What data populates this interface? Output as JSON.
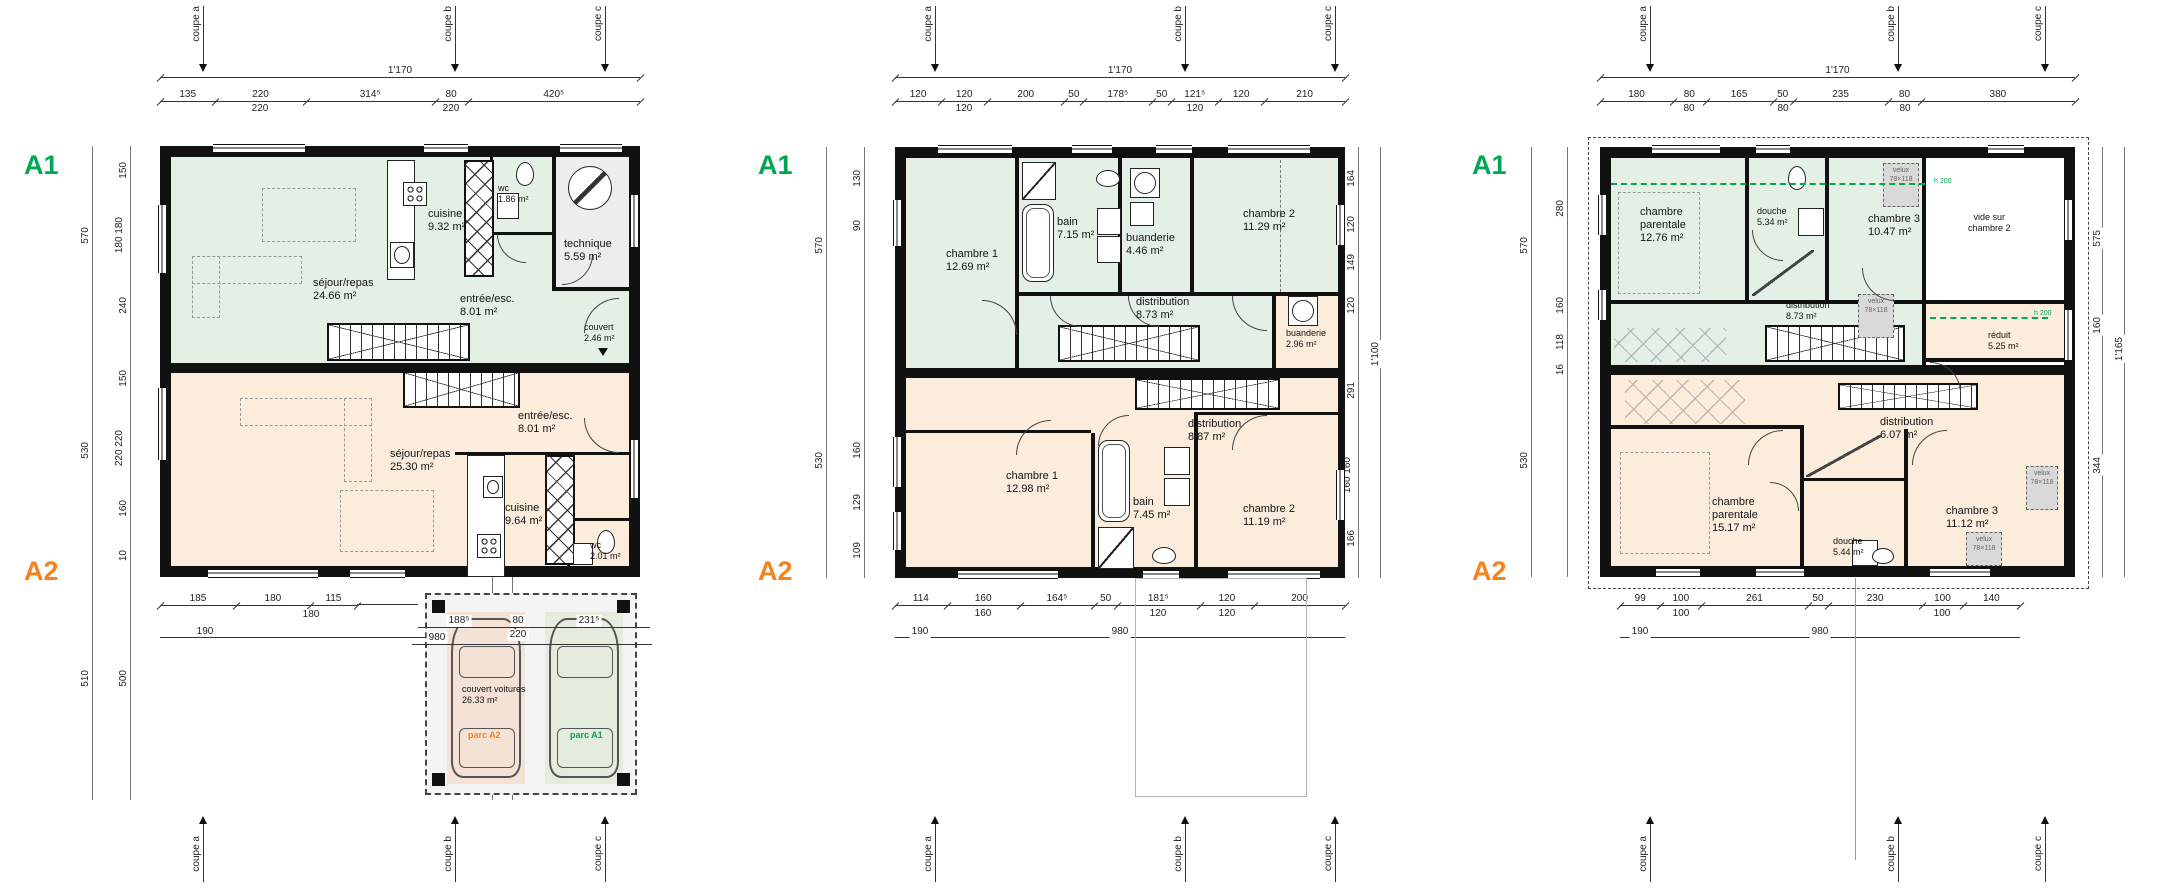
{
  "palette": {
    "a1": "#00a651",
    "a2": "#f6821f",
    "room_green": "#e4f0e6",
    "room_orange": "#fcecdc",
    "room_gray": "#ededed",
    "velux_gray": "#d9d9d9",
    "garage_bg": "#f4f4f4",
    "stall_a2": "#f3e2d5",
    "stall_a1": "#e3ecdd",
    "wall": "#111111"
  },
  "plans": [
    {
      "a1_label": "A1",
      "a2_label": "A2",
      "coupes": [
        "coupe a",
        "coupe b",
        "coupe c"
      ],
      "dims": {
        "top_total": "1'170",
        "top": [
          "135",
          "220",
          "314⁵",
          "80",
          "420⁵"
        ],
        "top2": [
          "220",
          "220"
        ],
        "left_outer": [
          "570",
          "530",
          "510"
        ],
        "left_inner": [
          "150",
          "180 180",
          "240",
          "150",
          "220 220",
          "160",
          "10",
          "500"
        ],
        "right_inner": [
          "387",
          "40",
          "220",
          "153",
          "90",
          "205",
          "120",
          "95"
        ],
        "right_outer": [
          "1'100",
          "510"
        ],
        "bottom": [
          "185",
          "180",
          "115"
        ],
        "bottom_garage": [
          "188⁵",
          "80",
          "231⁵"
        ],
        "bottom2": [
          "180",
          "220"
        ],
        "bottom3": [
          "190",
          "980"
        ]
      },
      "rooms": {
        "sejour_a1": {
          "name": "séjour/repas",
          "area": "24.66 m²"
        },
        "cuisine_a1": {
          "name": "cuisine",
          "area": "9.32 m²"
        },
        "wc_a1": {
          "name": "wc",
          "area": "1.86 m²"
        },
        "technique": {
          "name": "technique",
          "area": "5.59 m²"
        },
        "entree_a1": {
          "name": "entrée/esc.",
          "area": "8.01 m²"
        },
        "couvert": {
          "name": "couvert",
          "area": "2.46 m²"
        },
        "sejour_a2": {
          "name": "séjour/repas",
          "area": "25.30 m²"
        },
        "entree_a2": {
          "name": "entrée/esc.",
          "area": "8.01 m²"
        },
        "cuisine_a2": {
          "name": "cuisine",
          "area": "9.64 m²"
        },
        "wc_a2": {
          "name": "wc",
          "area": "2.01 m²"
        },
        "garage": {
          "name": "couvert voitures",
          "area": "26.33 m²"
        }
      },
      "parking": {
        "left": "parc A2",
        "right": "parc A1"
      }
    },
    {
      "a1_label": "A1",
      "a2_label": "A2",
      "coupes": [
        "coupe a",
        "coupe b",
        "coupe c"
      ],
      "dims": {
        "top_total": "1'170",
        "top": [
          "120",
          "120",
          "200",
          "50",
          "178⁵",
          "50",
          "121⁵",
          "120",
          "210"
        ],
        "top2": [
          "120",
          "120"
        ],
        "left_outer": [
          "570",
          "530"
        ],
        "left_inner": [
          "130",
          "90",
          "160",
          "129",
          "109"
        ],
        "right_inner": [
          "164",
          "120",
          "149",
          "120",
          "291",
          "160 160",
          "166"
        ],
        "right_outer": [
          "1'100"
        ],
        "bottom": [
          "114",
          "160",
          "164⁵",
          "50",
          "181⁵",
          "120",
          "200"
        ],
        "bottom2": [
          "160",
          "120",
          "120"
        ],
        "bottom3": [
          "190",
          "980"
        ]
      },
      "rooms": {
        "chambre1_a1": {
          "name": "chambre 1",
          "area": "12.69 m²"
        },
        "bain_a1": {
          "name": "bain",
          "area": "7.15 m²"
        },
        "buanderie_a1": {
          "name": "buanderie",
          "area": "4.46 m²"
        },
        "chambre2_a1": {
          "name": "chambre 2",
          "area": "11.29 m²"
        },
        "distribution_a1": {
          "name": "distribution",
          "area": "8.73 m²"
        },
        "buanderie_a2": {
          "name": "buanderie",
          "area": "2.96 m²"
        },
        "distribution_a2": {
          "name": "distribution",
          "area": "8.87 m²"
        },
        "chambre1_a2": {
          "name": "chambre 1",
          "area": "12.98 m²"
        },
        "bain_a2": {
          "name": "bain",
          "area": "7.45 m²"
        },
        "chambre2_a2": {
          "name": "chambre 2",
          "area": "11.19 m²"
        }
      }
    },
    {
      "a1_label": "A1",
      "a2_label": "A2",
      "coupes": [
        "coupe a",
        "coupe b",
        "coupe c"
      ],
      "dims": {
        "top_total": "1'170",
        "top": [
          "180",
          "80",
          "165",
          "50",
          "235",
          "80",
          "380"
        ],
        "top2": [
          "80",
          "80",
          "80"
        ],
        "left_outer": [
          "570",
          "530"
        ],
        "left_inner": [
          "280",
          "160",
          "118",
          "16"
        ],
        "right_inner": [
          "575",
          "160",
          "344"
        ],
        "right_outer": [
          "1'165"
        ],
        "bottom": [
          "99",
          "100",
          "261",
          "50",
          "230",
          "100",
          "140"
        ],
        "bottom2": [
          "100",
          "100"
        ],
        "bottom3": [
          "190",
          "980"
        ]
      },
      "rooms": {
        "parentale_a1": {
          "name": "chambre parentale",
          "area": "12.76 m²"
        },
        "douche_a1": {
          "name": "douche",
          "area": "5.34 m²"
        },
        "chambre3_a1": {
          "name": "chambre 3",
          "area": "10.47 m²"
        },
        "distribution_a1": {
          "name": "distribution",
          "area": "8.73 m²"
        },
        "vide": {
          "name": "vide sur",
          "area": "chambre 2"
        },
        "reduit": {
          "name": "réduit",
          "area": "5.25 m²"
        },
        "parentale_a2": {
          "name": "chambre parentale",
          "area": "15.17 m²"
        },
        "douche_a2": {
          "name": "douche",
          "area": "5.44 m²"
        },
        "chambre3_a2": {
          "name": "chambre 3",
          "area": "11.12 m²"
        },
        "distribution_a2": {
          "name": "distribution",
          "area": "6.07 m²"
        }
      },
      "annotations": {
        "velux": "velux",
        "velux_size": "78×118",
        "h200": "h 200"
      }
    }
  ]
}
